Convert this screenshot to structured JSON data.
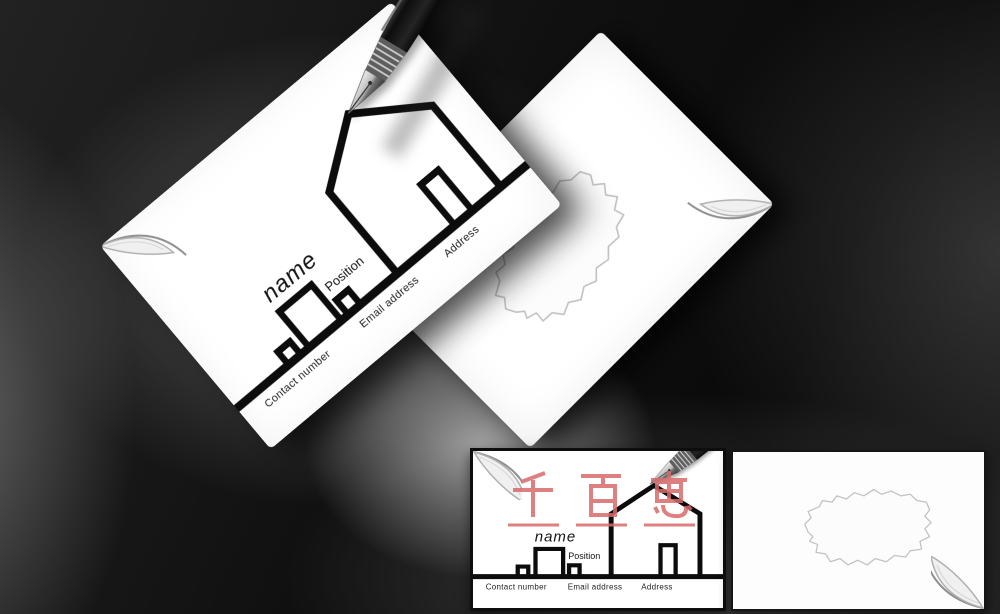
{
  "front_card": {
    "name": "name",
    "position": "Position",
    "contact_number": "Contact number",
    "email_address": "Email address",
    "address": "Address"
  },
  "watermark": {
    "text": "千百惠",
    "color": "#d96a6a"
  },
  "colors": {
    "background": "#0a0a0a",
    "card": "#ffffff",
    "ink": "#0d0d0d",
    "pen_body": "#141414",
    "stain_outline": "#c2c2c2",
    "watermark_red": "#d96a6a"
  }
}
